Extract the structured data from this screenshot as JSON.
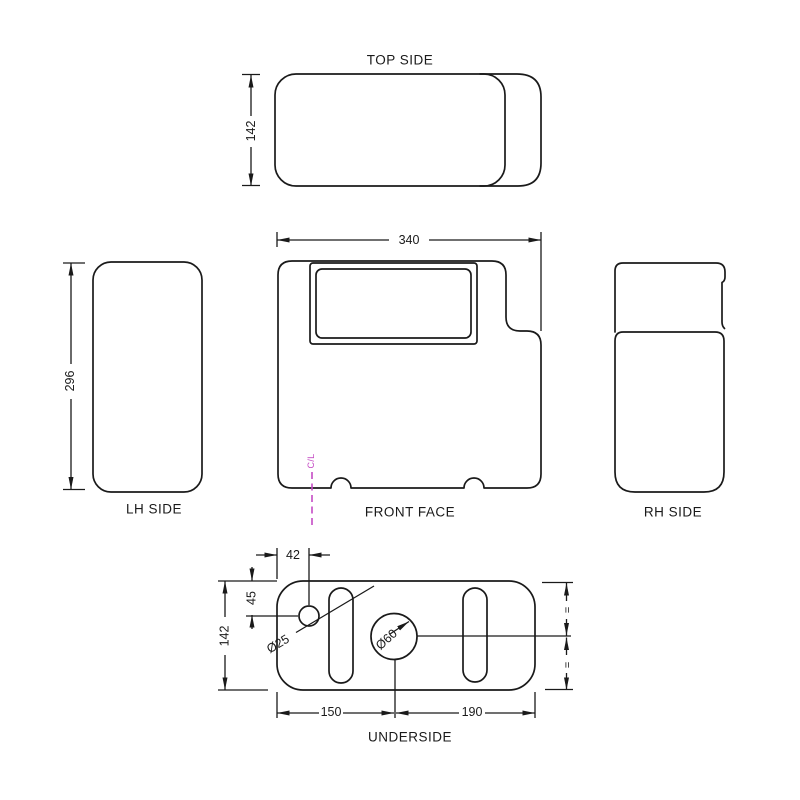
{
  "views": {
    "top": {
      "label": "TOP SIDE"
    },
    "front": {
      "label": "FRONT FACE",
      "centerline": "C/L"
    },
    "lh": {
      "label": "LH SIDE"
    },
    "rh": {
      "label": "RH SIDE"
    },
    "underside": {
      "label": "UNDERSIDE"
    }
  },
  "dimensions": {
    "top_depth": "142",
    "front_width": "340",
    "side_height": "296",
    "hole_offset_x": "42",
    "hole_offset_y": "45",
    "underside_depth": "142",
    "small_hole_dia": "Ø25",
    "large_hole_dia": "Ø60",
    "hole_center_from_left": "150",
    "hole_center_to_right": "190",
    "equal_spacing_mark": "="
  },
  "colors": {
    "line": "#1a1a1a",
    "centerline": "#c44bc4",
    "background": "#ffffff"
  }
}
